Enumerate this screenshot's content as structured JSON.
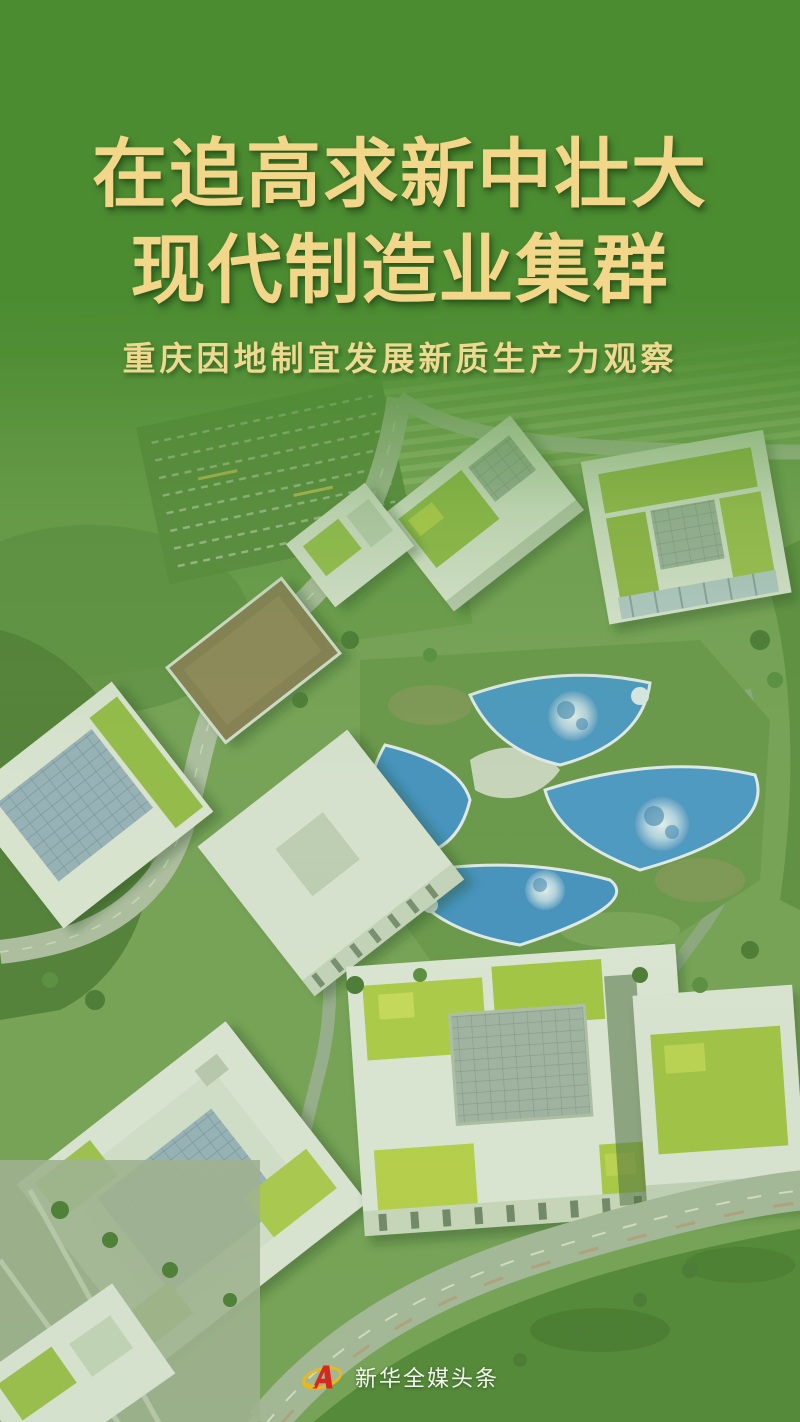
{
  "title": {
    "line1": "在追高求新中壮大",
    "line2": "现代制造业集群",
    "subtitle": "重庆因地制宜发展新质生产力观察"
  },
  "brand": {
    "logo_icon": "xinhua-emblem",
    "name": "新华全媒头条"
  },
  "colors": {
    "title_gold": "#f2d689",
    "subtitle_gold": "#edda90",
    "overlay_green": "#4c8c31",
    "footer_text": "#f4f7f0",
    "logo_red": "#d7281d",
    "logo_gold": "#e9b81f",
    "roof_blue": "#4d9bd0",
    "roof_grass": "#a9c94a"
  },
  "photo": {
    "type": "aerial-photograph",
    "scene": "modern campus with white buildings, green planted rooftops, solar panels, planet-painted blue roofs, curved roads and lawns, green wash overlay at top"
  }
}
